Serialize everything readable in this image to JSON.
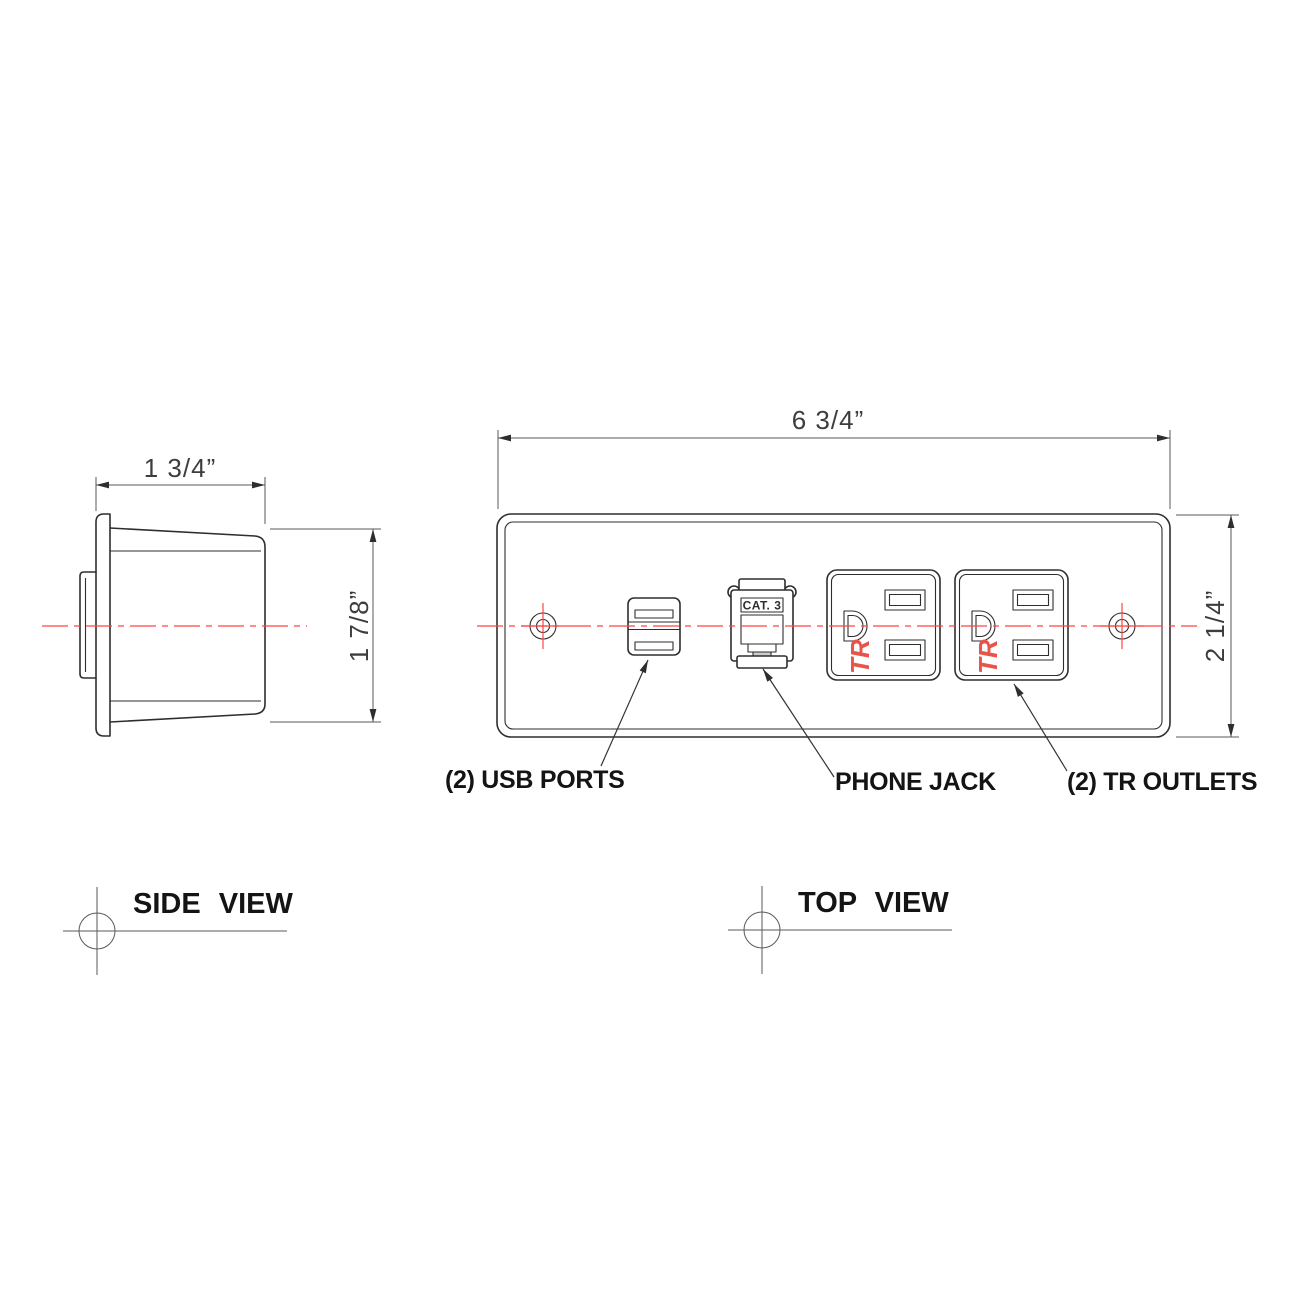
{
  "drawing": {
    "side_view": {
      "width_dim": "1 3/4”",
      "height_dim": "1 7/8”",
      "caption": "SIDE VIEW"
    },
    "top_view": {
      "width_dim": "6 3/4”",
      "height_dim": "2 1/4”",
      "caption": "TOP VIEW",
      "phone_jack_label": "CAT. 3",
      "outlet_mark": "TR",
      "callout_usb": "(2) USB PORTS",
      "callout_phone": "PHONE JACK",
      "callout_outlets": "(2) TR OUTLETS"
    },
    "colors": {
      "centerline_red": "#ff4540",
      "tr_mark_red": "#e8534a",
      "outline_dark": "#2e2e2e",
      "dimension_gray": "#5a5a5a"
    }
  }
}
